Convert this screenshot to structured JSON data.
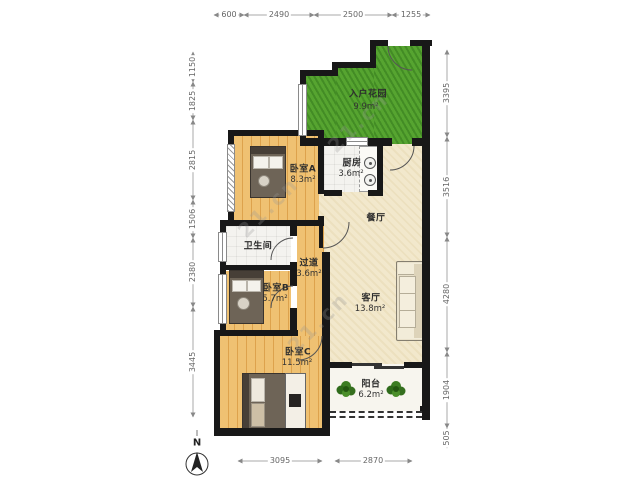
{
  "rooms": [
    {
      "name": "入户花园",
      "area": "9.9m²"
    },
    {
      "name": "卧室A",
      "area": "8.3m²"
    },
    {
      "name": "厨房",
      "area": "3.6m²"
    },
    {
      "name": "餐厅",
      "area": ""
    },
    {
      "name": "卫生间",
      "area": ""
    },
    {
      "name": "过道",
      "area": "3.6m²"
    },
    {
      "name": "卧室B",
      "area": "5.7m²"
    },
    {
      "name": "客厅",
      "area": "13.8m²"
    },
    {
      "name": "卧室C",
      "area": "11.5m²"
    },
    {
      "name": "阳台",
      "area": "6.2m²"
    }
  ],
  "dims": {
    "top": [
      "600",
      "2490",
      "2500",
      "1255"
    ],
    "left": [
      "1150",
      "1825",
      "2815",
      "1506",
      "2380",
      "3445"
    ],
    "right": [
      "3395",
      "3516",
      "4280",
      "1904",
      "505"
    ],
    "bottom": [
      "3095",
      "2870"
    ]
  },
  "compass": {
    "label": "N"
  },
  "watermark": "21.cn",
  "colors": {
    "wall": "#181818",
    "wood": "#e9b45e",
    "living": "#f2e8cc",
    "garden": "#4f9e2d",
    "tile": "#f4f3ef",
    "balcony": "#f7f5ee",
    "dim_text": "#666",
    "label_text": "#2d2d2d"
  }
}
